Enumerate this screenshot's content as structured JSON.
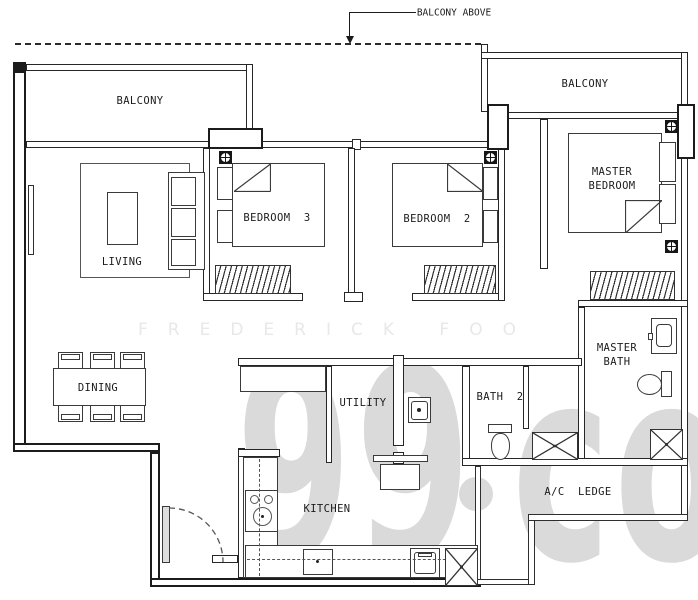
{
  "plan": {
    "note_balcony_above": "BALCONY ABOVE",
    "labels": {
      "balcony_left": "BALCONY",
      "balcony_right": "BALCONY",
      "living": "LIVING",
      "dining": "DINING",
      "bedroom3": "BEDROOM  3",
      "bedroom2": "BEDROOM  2",
      "master_bedroom_l1": "MASTER",
      "master_bedroom_l2": "BEDROOM",
      "master_bath_l1": "MASTER",
      "master_bath_l2": "BATH",
      "bath2": "BATH  2",
      "utility": "UTILITY",
      "kitchen": "KITCHEN",
      "ac_ledge": "A/C  LEDGE"
    },
    "watermark": {
      "agent_name": "FREDERICK FOO",
      "brand_99": "99",
      "brand_co": "co"
    },
    "colors": {
      "line": "#262626",
      "watermark_small": "#e8e8e8",
      "watermark_large": "#dadada",
      "background": "#ffffff"
    }
  }
}
